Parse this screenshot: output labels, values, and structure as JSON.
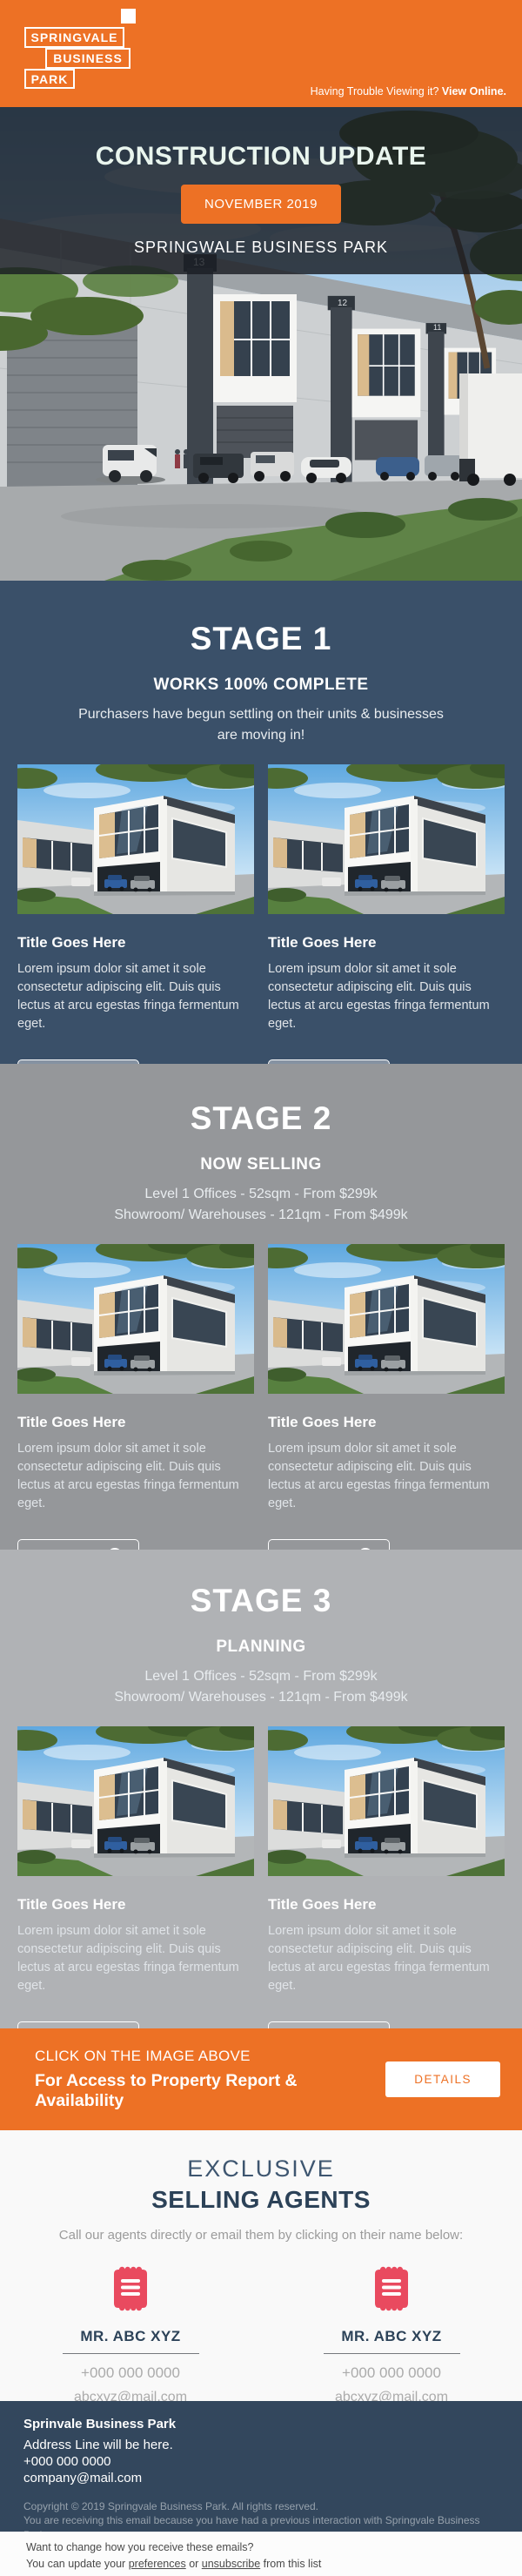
{
  "colors": {
    "orange": "#ED7125",
    "stage1_navy": "#3A5069",
    "stage2_gray": "#95979A",
    "stage3_gray": "#B0B2B5",
    "footer_navy": "#33475D",
    "agent_pink": "#E94A5F"
  },
  "header": {
    "logo": {
      "line1": "SPRINGVALE",
      "line2": "BUSINESS",
      "line3": "PARK"
    },
    "trouble_text": "Having Trouble Viewing it?",
    "view_online_label": "View Online."
  },
  "hero": {
    "title": "CONSTRUCTION UPDATE",
    "date_badge": "NOVEMBER 2019",
    "subtitle": "SPRINGWALE BUSINESS PARK"
  },
  "stages": [
    {
      "name": "STAGE 1",
      "status": "WORKS 100% COMPLETE",
      "desc_lines": [
        "Purchasers have begun settling on their units & businesses",
        "are moving in!"
      ],
      "cards": [
        {
          "title": "Title Goes Here",
          "body": "Lorem ipsum dolor sit amet it sole consectetur adipiscing elit. Duis quis lectus at arcu egestas fringa fermentum eget.",
          "button_label": "Know More"
        },
        {
          "title": "Title Goes Here",
          "body": "Lorem ipsum dolor sit amet it sole consectetur adipiscing elit. Duis quis lectus at arcu egestas fringa fermentum eget.",
          "button_label": "Know More"
        }
      ]
    },
    {
      "name": "STAGE 2",
      "status": "NOW SELLING",
      "desc_lines": [
        "Level 1 Offices - 52sqm - From $299k",
        "Showroom/ Warehouses - 121qm - From $499k"
      ],
      "cards": [
        {
          "title": "Title Goes Here",
          "body": "Lorem ipsum dolor sit amet it sole consectetur adipiscing elit. Duis quis lectus at arcu egestas fringa fermentum eget.",
          "button_label": "Know More"
        },
        {
          "title": "Title Goes Here",
          "body": "Lorem ipsum dolor sit amet it sole consectetur adipiscing elit. Duis quis lectus at arcu egestas fringa fermentum eget.",
          "button_label": "Know More"
        }
      ]
    },
    {
      "name": "STAGE 3",
      "status": "PLANNING",
      "desc_lines": [
        "Level 1 Offices - 52sqm - From $299k",
        "Showroom/ Warehouses - 121qm - From $499k"
      ],
      "cards": [
        {
          "title": "Title Goes Here",
          "body": "Lorem ipsum dolor sit amet it sole consectetur adipiscing elit. Duis quis lectus at arcu egestas fringa fermentum eget.",
          "button_label": "Know More"
        },
        {
          "title": "Title Goes Here",
          "body": "Lorem ipsum dolor sit amet it sole consectetur adipiscing elit. Duis quis lectus at arcu egestas fringa fermentum eget.",
          "button_label": "Know More"
        }
      ]
    }
  ],
  "cta": {
    "line1": "CLICK ON THE IMAGE ABOVE",
    "line2": "For Access to Property Report & Availability",
    "button_label": "DETAILS"
  },
  "agents": {
    "title_light": "EXCLUSIVE",
    "title_bold": "SELLING AGENTS",
    "subtitle": "Call our agents directly or email them by clicking on their name below:",
    "list": [
      {
        "name": "MR. ABC XYZ",
        "phone": "+000 000 0000",
        "email": "abcxyz@mail.com"
      },
      {
        "name": "MR. ABC XYZ",
        "phone": "+000 000 0000",
        "email": "abcxyz@mail.com"
      }
    ]
  },
  "footer": {
    "company": "Sprinvale Business Park",
    "address": "Address Line will be here.",
    "phone": "+000 000 0000",
    "email": "company@mail.com",
    "copyright": "Copyright © 2019 Springvale Business Park. All rights reserved.",
    "reason_line1": "You are receiving this email because you have had a previous interaction with Springvale Business Park or",
    "reason_line2": "“Parent Company” or “Selling Agent”."
  },
  "bottom": {
    "line1": "Want to change how you receive these emails?",
    "line2_prefix": "You can update your ",
    "preferences_label": "preferences",
    "line2_mid": " or ",
    "unsubscribe_label": "unsubscribe",
    "line2_suffix": " from this list"
  }
}
